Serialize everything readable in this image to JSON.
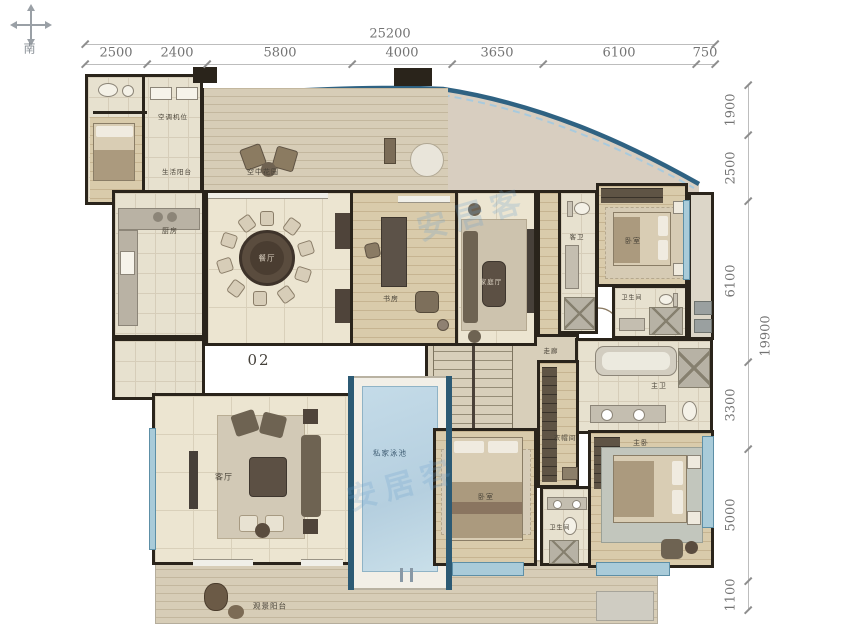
{
  "compass": {
    "south_label": "南"
  },
  "unit_label": "02",
  "watermark": "安居客",
  "dimensions": {
    "top_total": "25200",
    "top_segments": [
      "2500",
      "2400",
      "5800",
      "4000",
      "3650",
      "6100",
      "750"
    ],
    "right_total": "19900",
    "right_segments": [
      "1900",
      "2500",
      "6100",
      "3300",
      "5000",
      "1100"
    ]
  },
  "rooms": {
    "ac_platform": "空调机位",
    "service_balcony": "生活阳台",
    "sky_terrace": "空中花园",
    "kitchen": "厨房",
    "dining": "餐厅",
    "study": "书房",
    "family_room": "家庭厅",
    "corridor": "走廊",
    "guest_bath": "客卫",
    "bedroom_2": "卧室",
    "bath_2": "卫生间",
    "master_bath": "主卫",
    "closet": "衣帽间",
    "living": "客厅",
    "pool": "私家泳池",
    "bedroom_3": "卧室",
    "bath_3": "卫生间",
    "master_bedroom": "主卧",
    "view_balcony": "观景阳台"
  }
}
